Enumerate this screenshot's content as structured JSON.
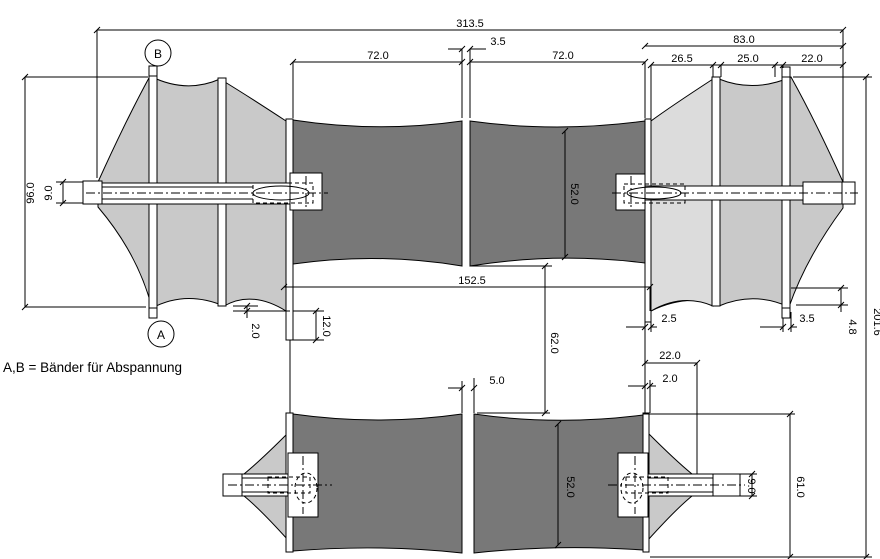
{
  "note": "A,B = Bänder für Abspannung",
  "markers": {
    "a": "A",
    "b": "B"
  },
  "colors": {
    "panel_dark": "#787878",
    "panel_light": "#c9c9c9",
    "panel_lighter": "#dcdcdc",
    "line": "#000000",
    "background": "#ffffff"
  },
  "dimensions": {
    "overall_width": "313.5",
    "center_gap_top": "3.5",
    "panel_72_left": "72.0",
    "panel_72_right": "72.0",
    "wing_total": "83.0",
    "wing_seg1": "26.5",
    "wing_seg2": "25.0",
    "wing_seg3": "22.0",
    "left_height": "96.0",
    "rod_height_left": "9.0",
    "panel_height_top": "52.0",
    "mid_width": "152.5",
    "gap_height": "62.0",
    "offset_left_small": "2.0",
    "corner_drop": "12.0",
    "strip_left": "2.5",
    "strip_right": "3.5",
    "edge_drop": "4.8",
    "overall_height": "201.6",
    "apex_offset": "22.0",
    "plate_offset": "2.0",
    "center_gap_bottom": "5.0",
    "panel_height_bottom": "52.0",
    "rod_height_bottom": "9.0",
    "bottom_height": "61.0"
  }
}
